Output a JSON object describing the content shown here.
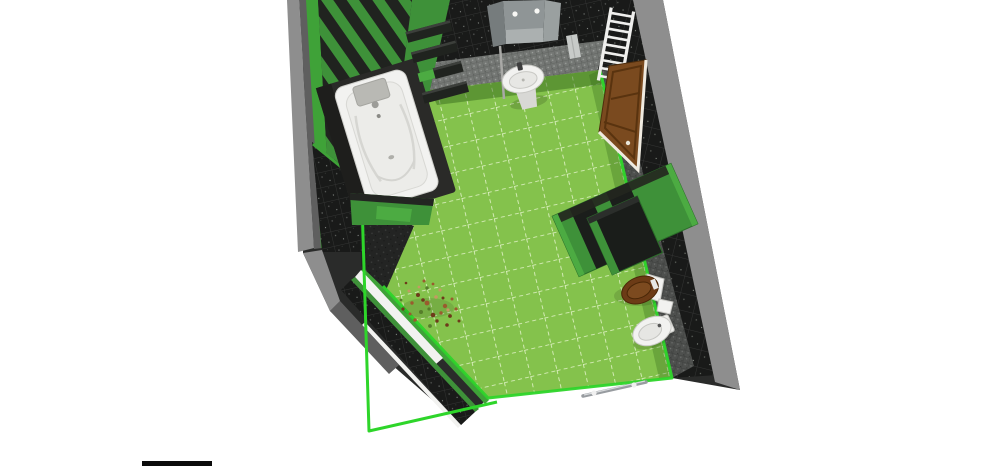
{
  "scene": {
    "view": "bathroom-floor-plan-3d-top-view",
    "room": "bathroom",
    "fixtures": [
      {
        "id": "bathtub",
        "label": "bathtub with dark surround and headrest"
      },
      {
        "id": "bathtub-platform",
        "label": "green tub platform end panel"
      },
      {
        "id": "wall-shelves",
        "label": "dark wall shelves on green wall"
      },
      {
        "id": "mirror",
        "label": "three-panel mirror with two lights"
      },
      {
        "id": "washbasin",
        "label": "white pedestal washbasin with tap"
      },
      {
        "id": "wall-towel",
        "label": "light towel on back wall"
      },
      {
        "id": "towel-radiator",
        "label": "white ladder towel radiator"
      },
      {
        "id": "door",
        "label": "brown panelled door with white frame"
      },
      {
        "id": "partition-screen",
        "label": "green and black partition screen"
      },
      {
        "id": "toilet",
        "label": "toilet with brown wooden seat and white cistern"
      },
      {
        "id": "toilet-accessory",
        "label": "small white box beside toilet"
      },
      {
        "id": "bidet",
        "label": "white bidet"
      },
      {
        "id": "window-plant",
        "label": "dried plant on white windowsill"
      },
      {
        "id": "towel-bar",
        "label": "chrome towel bar at open wall edge"
      },
      {
        "id": "room-outline",
        "label": "bright green room boundary outline"
      }
    ]
  },
  "colors": {
    "background": "#FFFFFF",
    "floor_green": "#84C24C",
    "floor_grout": "#E9F6D2",
    "outline_green": "#2ED52A",
    "green_wall": "#3E9139",
    "green_wall_bright": "#4CAB42",
    "green_trim": "#3FA238",
    "stripe_dark": "#20231F",
    "wall_black": "#191A19",
    "wall_grout": "#343534",
    "mosaic_gray": "#747774",
    "mosaic_dark": "#4E504E",
    "wall_top_gray": "#8E8E8E",
    "wall_outer_dark": "#5F5F5F",
    "fixture_white": "#F2F2F0",
    "fixture_shade": "#D8D8D5",
    "fixture_line": "#BFBFBB",
    "mirror_gray": "#8F9596",
    "mirror_dark": "#767C7D",
    "door_brown": "#7A4A1F",
    "door_dark": "#59330F",
    "door_frame": "#EFEAE0",
    "seat_brown": "#6C3B16",
    "radiator_white": "#EFEFED",
    "rail_gray": "#989CA0",
    "plant_rust": "#9A5B2E",
    "plant_dark": "#6E3A1A",
    "plant_green": "#567E2B",
    "plant_light": "#C49A63",
    "floor_shadow": "#2F6218"
  }
}
